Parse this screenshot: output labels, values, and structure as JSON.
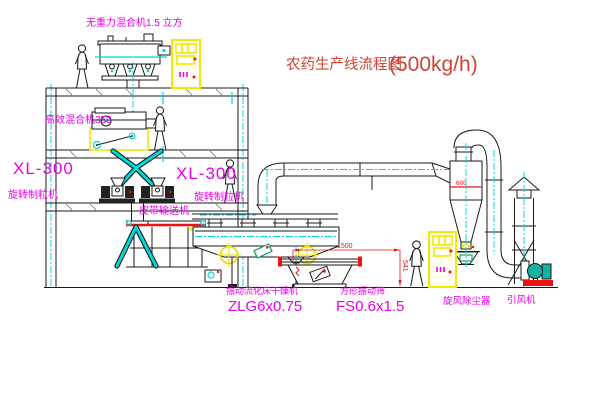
{
  "title": {
    "cn": "农药生产线流程图",
    "capacity": "(500kg/h)"
  },
  "labels": {
    "gravity_mixer": "无重力混合机1.5 立方",
    "high_mixer": "高效混合机350",
    "granulator_model_left": "XL-300",
    "granulator_name_left": "旋转制粒机",
    "granulator_model_mid": "XL-300",
    "granulator_name_mid": "旋转制粒机",
    "belt_conveyor": "皮带输送机",
    "dryer_name": "振动流化床干燥机",
    "dryer_model": "ZLG6x0.75",
    "sieve_name": "方形振动筛",
    "sieve_model": "FS0.6x1.5",
    "cyclone": "旋风除尘器",
    "fan": "引风机"
  },
  "dimensions": {
    "sieve_length": "1500",
    "sieve_height": "541",
    "cyclone_diameter": "600"
  },
  "colors": {
    "line_black": "#1a1a1a",
    "centerline_cyan": "#00d8d8",
    "label_magenta": "#e800e8",
    "dimension_red": "#ee1111",
    "title_red": "#cc4433",
    "cabinet_yellow": "#f0ea00",
    "machine_teal": "#14b0a0"
  }
}
